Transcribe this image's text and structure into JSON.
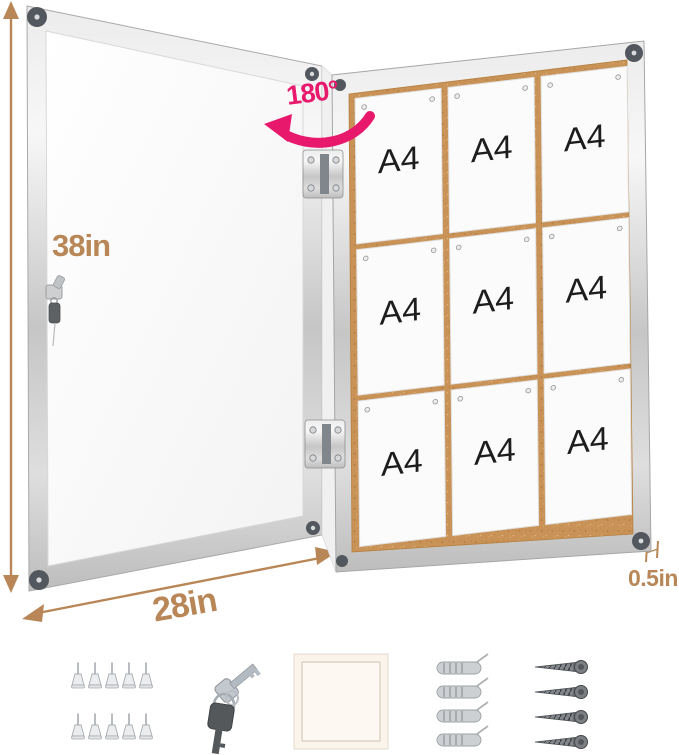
{
  "annotations": {
    "rotation": "180°",
    "height": "38in",
    "width": "28in",
    "depth": "0.5in"
  },
  "board": {
    "papers": [
      "A4",
      "A4",
      "A4",
      "A4",
      "A4",
      "A4",
      "A4",
      "A4",
      "A4"
    ],
    "grid": "3x3"
  },
  "accessories": {
    "push_pins": {
      "name": "push-pins",
      "count": 10
    },
    "keys": {
      "name": "keys",
      "count": 2
    },
    "pad": {
      "name": "adhesive-pad",
      "count": 1
    },
    "anchors": {
      "name": "wall-anchors",
      "count": 4
    },
    "screws": {
      "name": "mounting-screws",
      "count": 4
    }
  },
  "colors": {
    "dimension_tan": "#B98757",
    "accent_pink": "#E8186C",
    "cork": "#C99257",
    "frame_silver": "#D9D9D9",
    "corner_cap": "#53585E"
  }
}
